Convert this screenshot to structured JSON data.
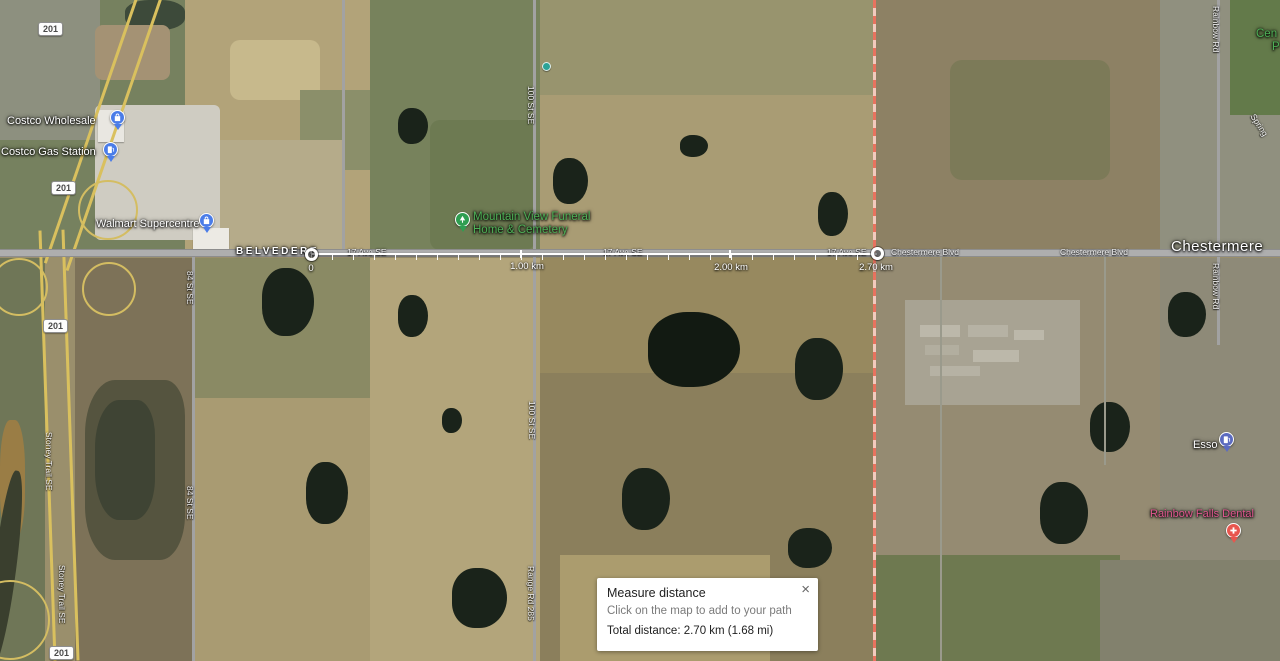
{
  "dialog": {
    "title": "Measure distance",
    "instruction": "Click on the map to add to your path",
    "total": "Total distance: 2.70 km (1.68 mi)",
    "close_icon": "×"
  },
  "measure": {
    "start_label": "0",
    "km1_label": "1.00 km",
    "km2_label": "2.00 km",
    "end_label": "2.70 km"
  },
  "pois": {
    "costco_wholesale": "Costco Wholesale",
    "costco_gas": "Costco Gas Station",
    "walmart": "Walmart Supercentre",
    "funeral_line1": "Mountain View Funeral",
    "funeral_line2": "Home & Cemetery",
    "esso": "Esso",
    "dental": "Rainbow Falls Dental"
  },
  "areas": {
    "belvedere": "BELVEDERE",
    "chestermere": "Chestermere",
    "park_cut_line1": "Cen",
    "park_cut_line2": "P"
  },
  "roads": {
    "ave17": "17 Ave SE",
    "chestermere_blvd": "Chestermere Blvd",
    "stoney_trail": "Stoney Trail SE",
    "st84": "84 St SE",
    "st100": "100 St SE",
    "range_rd": "Range Rd 285",
    "rainbow_rd": "Rainbow Rd",
    "spring_cut": "Spring",
    "highway_shield": "201"
  },
  "colors": {
    "pin_blue": "#4a7ce8",
    "pin_indigo": "#5c6bc0",
    "pin_green": "#2f9e51",
    "pin_red": "#e8564e",
    "label_green": "#4db056",
    "label_pink": "#e0578f",
    "boundary_red": "#e8735f",
    "highway_yellow": "#d9c05e",
    "measure_line": "#ffffff"
  }
}
